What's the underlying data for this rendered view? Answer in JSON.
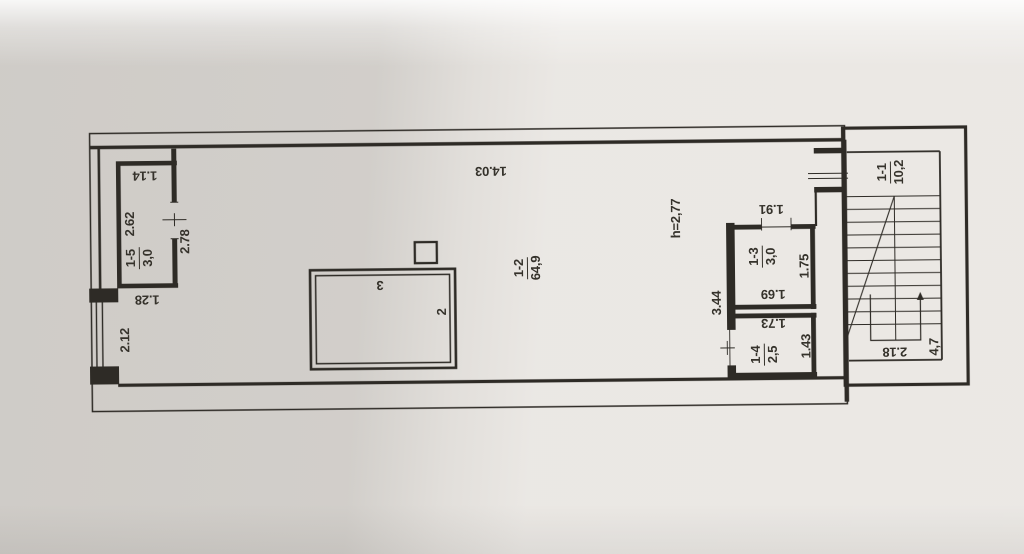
{
  "plan": {
    "rooms": [
      {
        "id": "1-1",
        "area": "10,2"
      },
      {
        "id": "1-2",
        "area": "64,9"
      },
      {
        "id": "1-3",
        "area": "3,0"
      },
      {
        "id": "1-4",
        "area": "2,5"
      },
      {
        "id": "1-5",
        "area": "3,0"
      }
    ],
    "ceiling_height": "h=2,77",
    "dims": {
      "room15_top": "1.14",
      "room15_side": "2.62",
      "opening_278": "2.78",
      "pier_128": "1.28",
      "window_212": "2.12",
      "hall_top": "14.03",
      "door13_191": "1.91",
      "room13_side": "1.75",
      "room13_bottom": "1.69",
      "wall_344": "3.44",
      "room14_top": "1.73",
      "room14_side": "1.43",
      "stairs_width": "2.18",
      "stairs_length": "4,7"
    },
    "annotations": {
      "box_top": "3",
      "box_side": "2"
    },
    "colors": {
      "ink": "#2e2b26",
      "paper": "#e9e6e2"
    }
  }
}
